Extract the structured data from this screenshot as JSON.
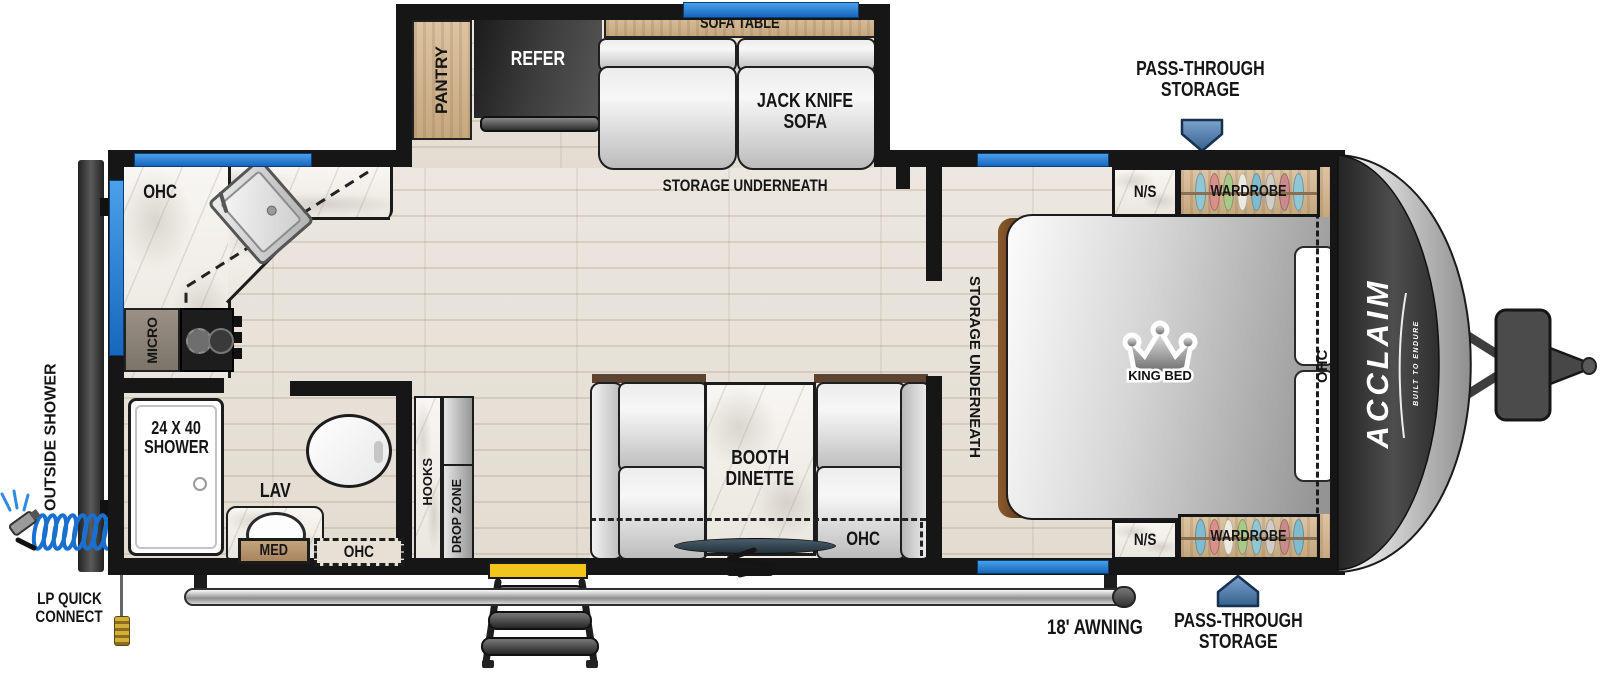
{
  "brand": {
    "name": "ACCLAIM",
    "tagline": "BUILT TO ENDURE"
  },
  "slide_out": {
    "pantry": "PANTRY",
    "refer": "REFER",
    "sofa_table": "SOFA TABLE",
    "sofa_line1": "JACK KNIFE",
    "sofa_line2": "SOFA",
    "storage": "STORAGE UNDERNEATH"
  },
  "bedroom": {
    "pass_through_top_line1": "PASS-THROUGH",
    "pass_through_top_line2": "STORAGE",
    "pass_through_bottom_line1": "PASS-THROUGH",
    "pass_through_bottom_line2": "STORAGE",
    "nightstand_top": "N/S",
    "nightstand_bottom": "N/S",
    "wardrobe_top": "WARDROBE",
    "wardrobe_bottom": "WARDROBE",
    "king_bed": "KING BED",
    "storage": "STORAGE UNDERNEATH",
    "ohc": "OHC"
  },
  "kitchen": {
    "ohc": "OHC",
    "micro": "MICRO"
  },
  "bathroom": {
    "shower_line1": "24 X 40",
    "shower_line2": "SHOWER",
    "lav": "LAV",
    "med": "MED",
    "ohc": "OHC"
  },
  "entry": {
    "hooks": "HOOKS",
    "drop_zone": "DROP ZONE"
  },
  "dinette": {
    "name_line1": "BOOTH",
    "name_line2": "DINETTE",
    "ohc": "OHC"
  },
  "exterior": {
    "outside_shower": "OUTSIDE SHOWER",
    "lp_connect_line1": "LP QUICK",
    "lp_connect_line2": "CONNECT",
    "awning": "18' AWNING"
  },
  "colors": {
    "window_blue": "#1e7ad6",
    "arrow_blue": "#4f7fb0",
    "door_yellow": "#f2c51d",
    "wall": "#161616"
  }
}
